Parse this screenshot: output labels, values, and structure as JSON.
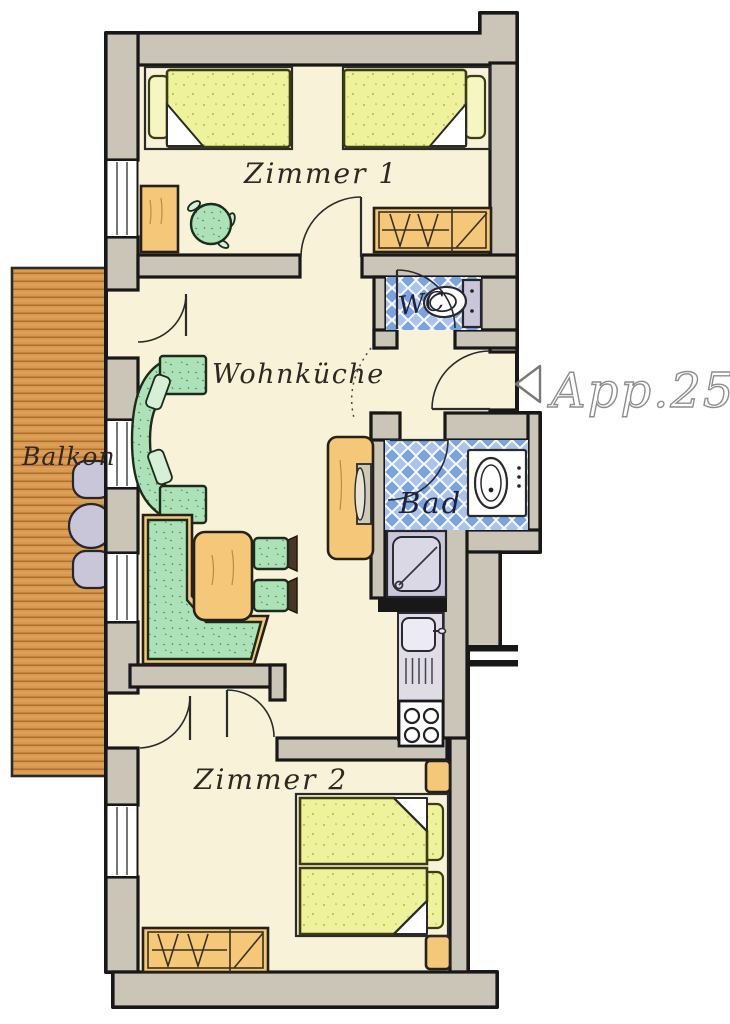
{
  "floorplan": {
    "apartment_label": "App.25",
    "rooms": {
      "zimmer1": "Zimmer 1",
      "wohnkueche": "Wohnküche",
      "balkon": "Balkon",
      "wc": "WC",
      "bad": "Bad",
      "zimmer2": "Zimmer 2"
    },
    "icons": {
      "entry_arrow": "◁"
    }
  },
  "palette": {
    "wall": "#cbc5b8",
    "line": "#181818",
    "floor": "#f8f3d8",
    "wood": "#f4c878",
    "fabric_green": "#ade2b8",
    "bed_yellow": "#eef39b",
    "tile_blue": "#7ba3de",
    "tile_blue_light": "#a9c3ec",
    "deck_wood": "#d9994f",
    "fixture_grey": "#cac6da",
    "label_dark": "#2d2822",
    "label_blue": "#20203c",
    "apartment_label_grey": "#8d8d8d"
  }
}
